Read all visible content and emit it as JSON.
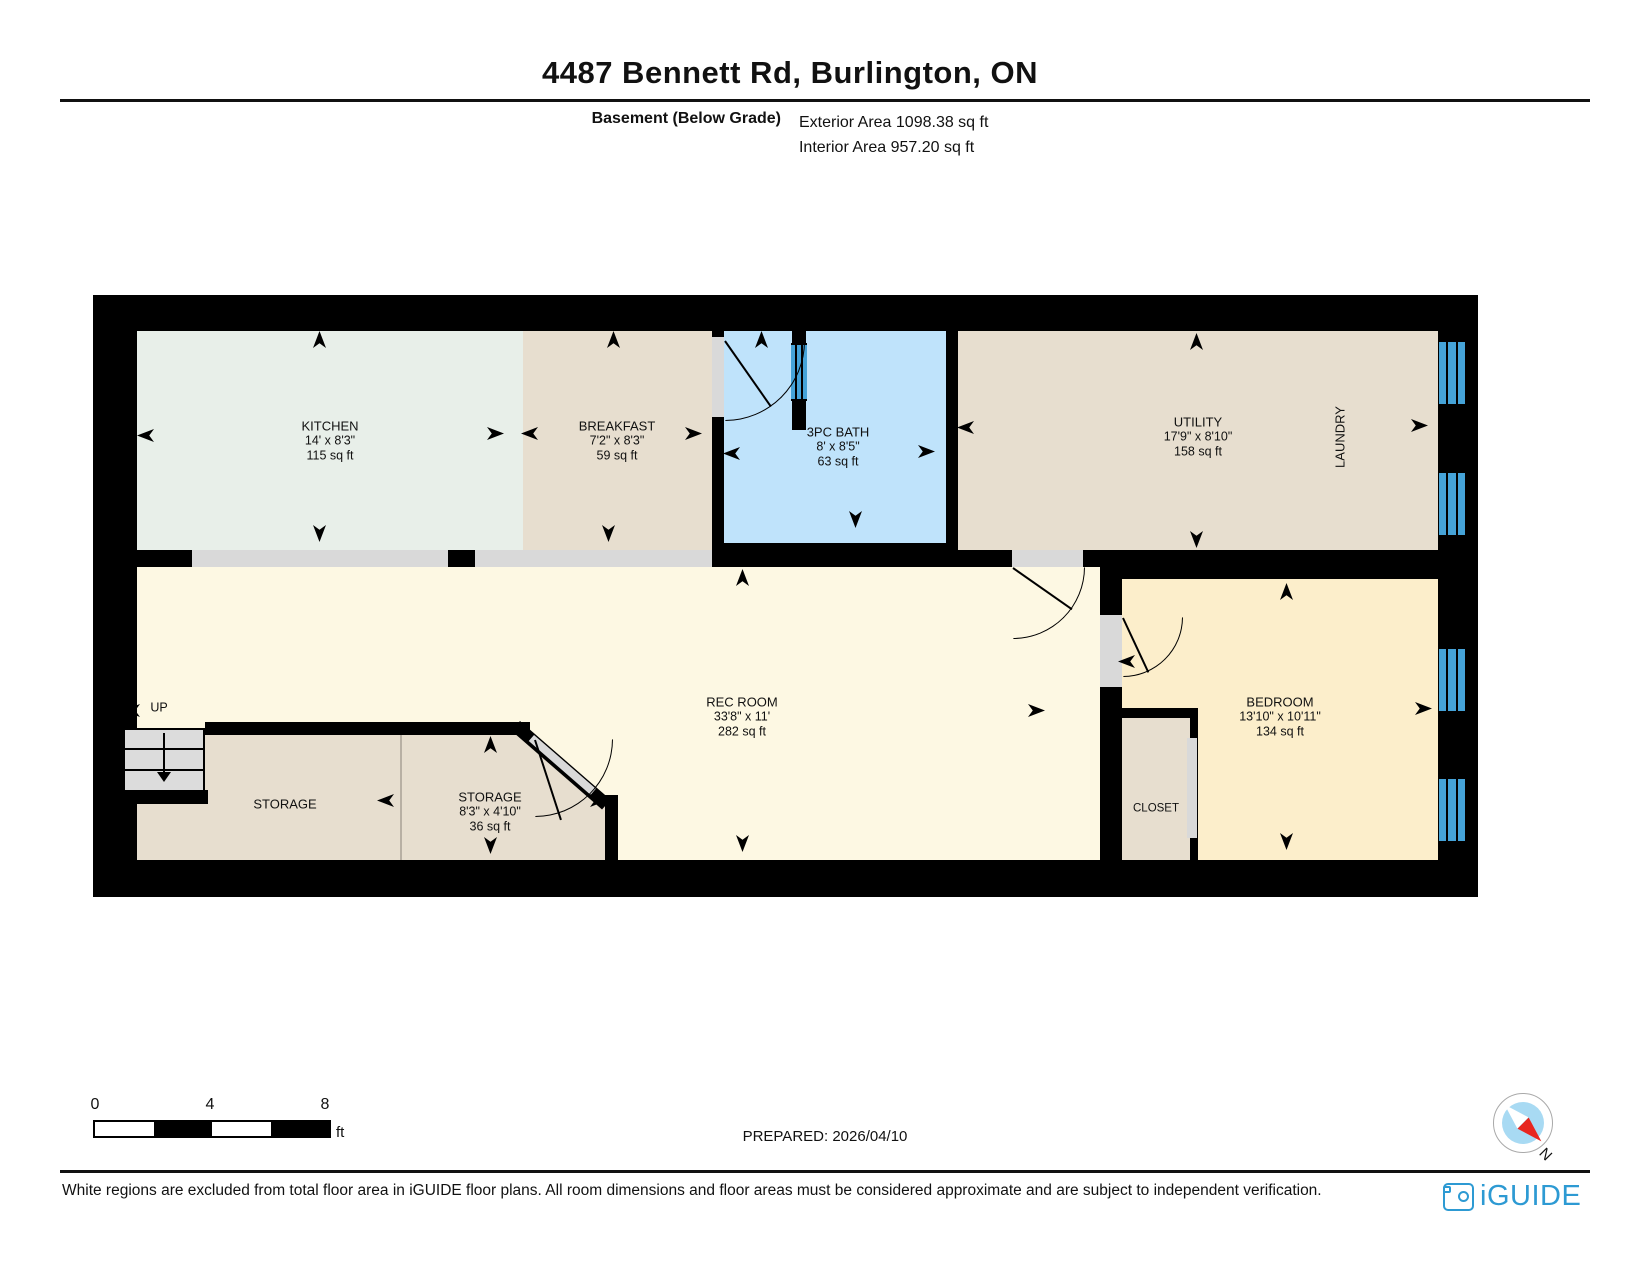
{
  "header": {
    "title": "4487 Bennett Rd, Burlington, ON",
    "floor_label": "Basement (Below Grade)",
    "exterior_area": "Exterior Area 1098.38 sq ft",
    "interior_area": "Interior Area 957.20 sq ft"
  },
  "rooms": {
    "kitchen": {
      "name": "KITCHEN",
      "dims": "14' x 8'3\"",
      "area": "115 sq ft"
    },
    "breakfast": {
      "name": "BREAKFAST",
      "dims": "7'2\" x 8'3\"",
      "area": "59 sq ft"
    },
    "bath": {
      "name": "3PC BATH",
      "dims": "8' x 8'5\"",
      "area": "63 sq ft"
    },
    "utility": {
      "name": "UTILITY",
      "dims": "17'9\" x 8'10\"",
      "area": "158 sq ft"
    },
    "laundry": {
      "name": "LAUNDRY"
    },
    "rec_room": {
      "name": "REC ROOM",
      "dims": "33'8\" x 11'",
      "area": "282 sq ft"
    },
    "storage": {
      "name": "STORAGE"
    },
    "storage2": {
      "name": "STORAGE",
      "dims": "8'3\" x 4'10\"",
      "area": "36 sq ft"
    },
    "closet": {
      "name": "CLOSET"
    },
    "bedroom": {
      "name": "BEDROOM",
      "dims": "13'10\" x 10'11\"",
      "area": "134 sq ft"
    }
  },
  "stairs": {
    "label": "UP"
  },
  "scale_bar": {
    "tick0": "0",
    "tick1": "4",
    "tick2": "8",
    "unit": "ft"
  },
  "prepared_label": "PREPARED: 2026/04/10",
  "compass": {
    "north": "N"
  },
  "footer": {
    "disclaimer": "White regions are excluded from total floor area in iGUIDE floor plans. All room dimensions and floor areas must be considered approximate and are subject to independent verification.",
    "brand": "iGUIDE"
  },
  "colors": {
    "wall": "#000000",
    "kitchen_fill": "#e8efe9",
    "tan_fill": "#e7decf",
    "bath_fill": "#bfe3fb",
    "rec_fill": "#fdf8e3",
    "bedroom_fill": "#fceecb",
    "opening_fill": "#d9d9d9",
    "window_blue": "#45a3d8",
    "brand_blue": "#2d9ad3"
  }
}
